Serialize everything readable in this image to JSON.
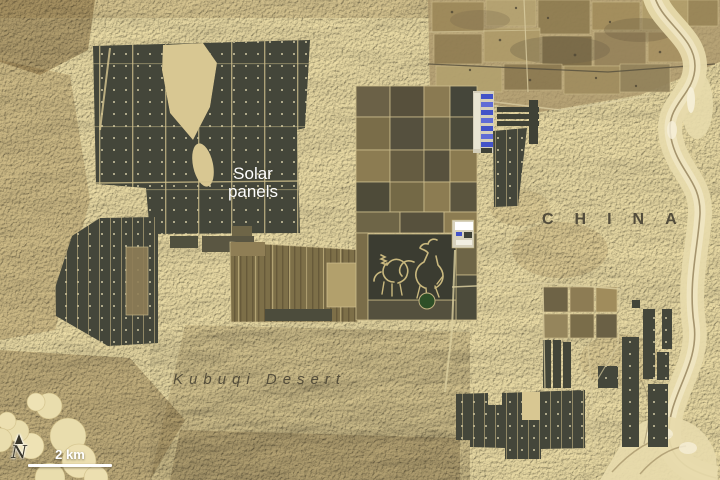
{
  "annotations": {
    "solar_panels": {
      "line1": "Solar",
      "line2": "panels"
    },
    "country": "CHINA",
    "desert": "Kubuqi Desert",
    "scale_bar_label": "2 km",
    "compass_label": "N"
  },
  "colors": {
    "sand": "#d9c893",
    "dune_shadow": "#8a7048",
    "solar_panel_dark": "#44463a",
    "panel_dot": "#e9dfb5",
    "farm_field_brown": "#8a7850",
    "riverbed_wash": "#e7daab",
    "building_blue": "#4353c8",
    "pond_green": "#2e4f27",
    "label_light": "#ffffff",
    "label_dark": "#49433a"
  }
}
